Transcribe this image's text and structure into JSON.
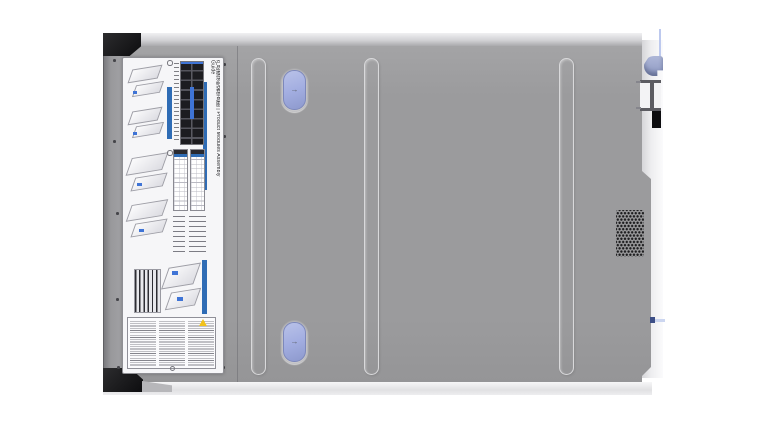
{
  "label": {
    "title": "产品模块组装信息图 | Product Modules Assembly Guide"
  },
  "icons": {
    "latch_arrow": "→",
    "warning_icon": "⚠"
  },
  "colors": {
    "cover_gray": "#9b9b9d",
    "cover_edge_light": "#eeeef0",
    "rib_stroke": "#d9d9db",
    "latch_button_blue": "#a3aee1",
    "latch_button_border": "#7d88bb",
    "label_background": "#f6f6f8",
    "label_accent_blue": "#2f6cb5",
    "drive_grid_black": "#1c1c20",
    "rack_ear_black": "#0d0d0f",
    "vent_dot": "#1d1d1f",
    "hook_blue": "#9aa5c8",
    "clip_blue": "#3c4e86",
    "cable_blue": "#bdc9ee",
    "warning_yellow": "#f2c21b"
  }
}
